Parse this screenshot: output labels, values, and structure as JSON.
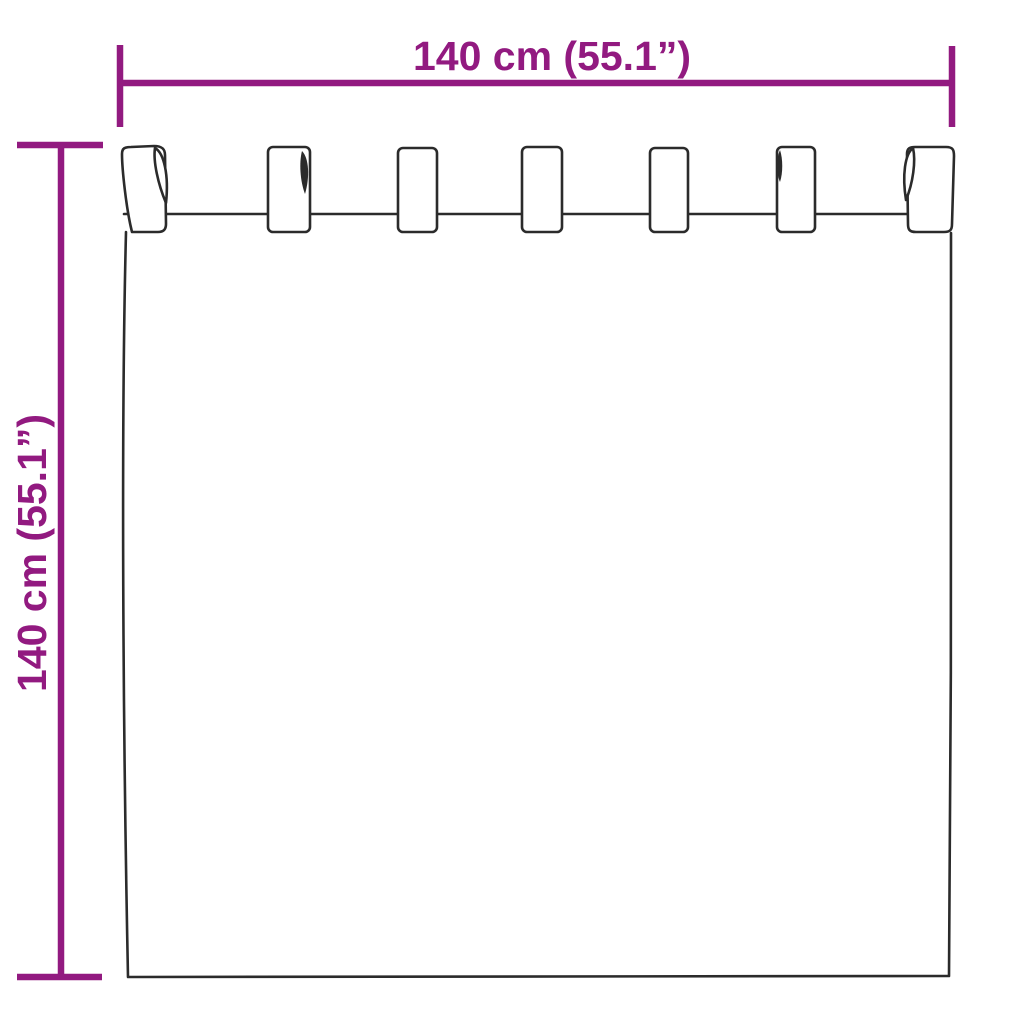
{
  "diagram": {
    "width_label": "140 cm (55.1”)",
    "height_label": "140 cm (55.1”)",
    "accent_color": "#921A80",
    "line_color": "#2B2B2B",
    "background_color": "#FFFFFF",
    "tab_count": 7
  }
}
